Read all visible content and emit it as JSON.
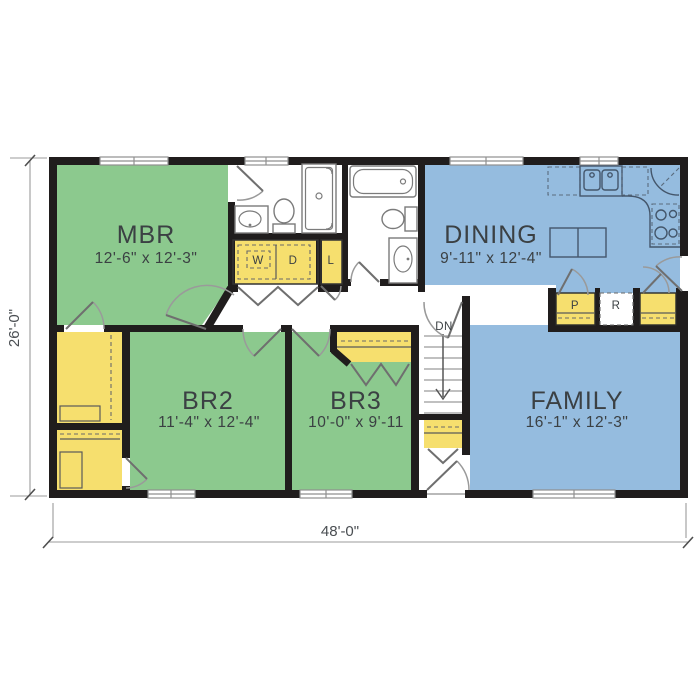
{
  "plan": {
    "title": "single-story house floor plan",
    "rooms": [
      {
        "id": "mbr",
        "name": "MBR",
        "dims": "12'-6\" x 12'-3\""
      },
      {
        "id": "dining",
        "name": "DINING",
        "dims": "9'-11\" x 12'-4\""
      },
      {
        "id": "br2",
        "name": "BR2",
        "dims": "11'-4\" x 12'-4\""
      },
      {
        "id": "br3",
        "name": "BR3",
        "dims": "10'-0\" x 9'-11"
      },
      {
        "id": "family",
        "name": "FAMILY",
        "dims": "16'-1\" x 12'-3\""
      }
    ],
    "labels": {
      "washer": "W",
      "dryer": "D",
      "linen": "L",
      "pantry": "P",
      "refrigerator": "R",
      "stairs_down": "DN"
    },
    "dimensions": {
      "width": "48'-0\"",
      "height": "26'-0\""
    },
    "colors": {
      "bedroom_green": "#8cc98e",
      "living_blue": "#95bcdf",
      "closet_yellow": "#f6df6e",
      "wall_black": "#201d1d",
      "floor_white": "#ffffff"
    }
  }
}
